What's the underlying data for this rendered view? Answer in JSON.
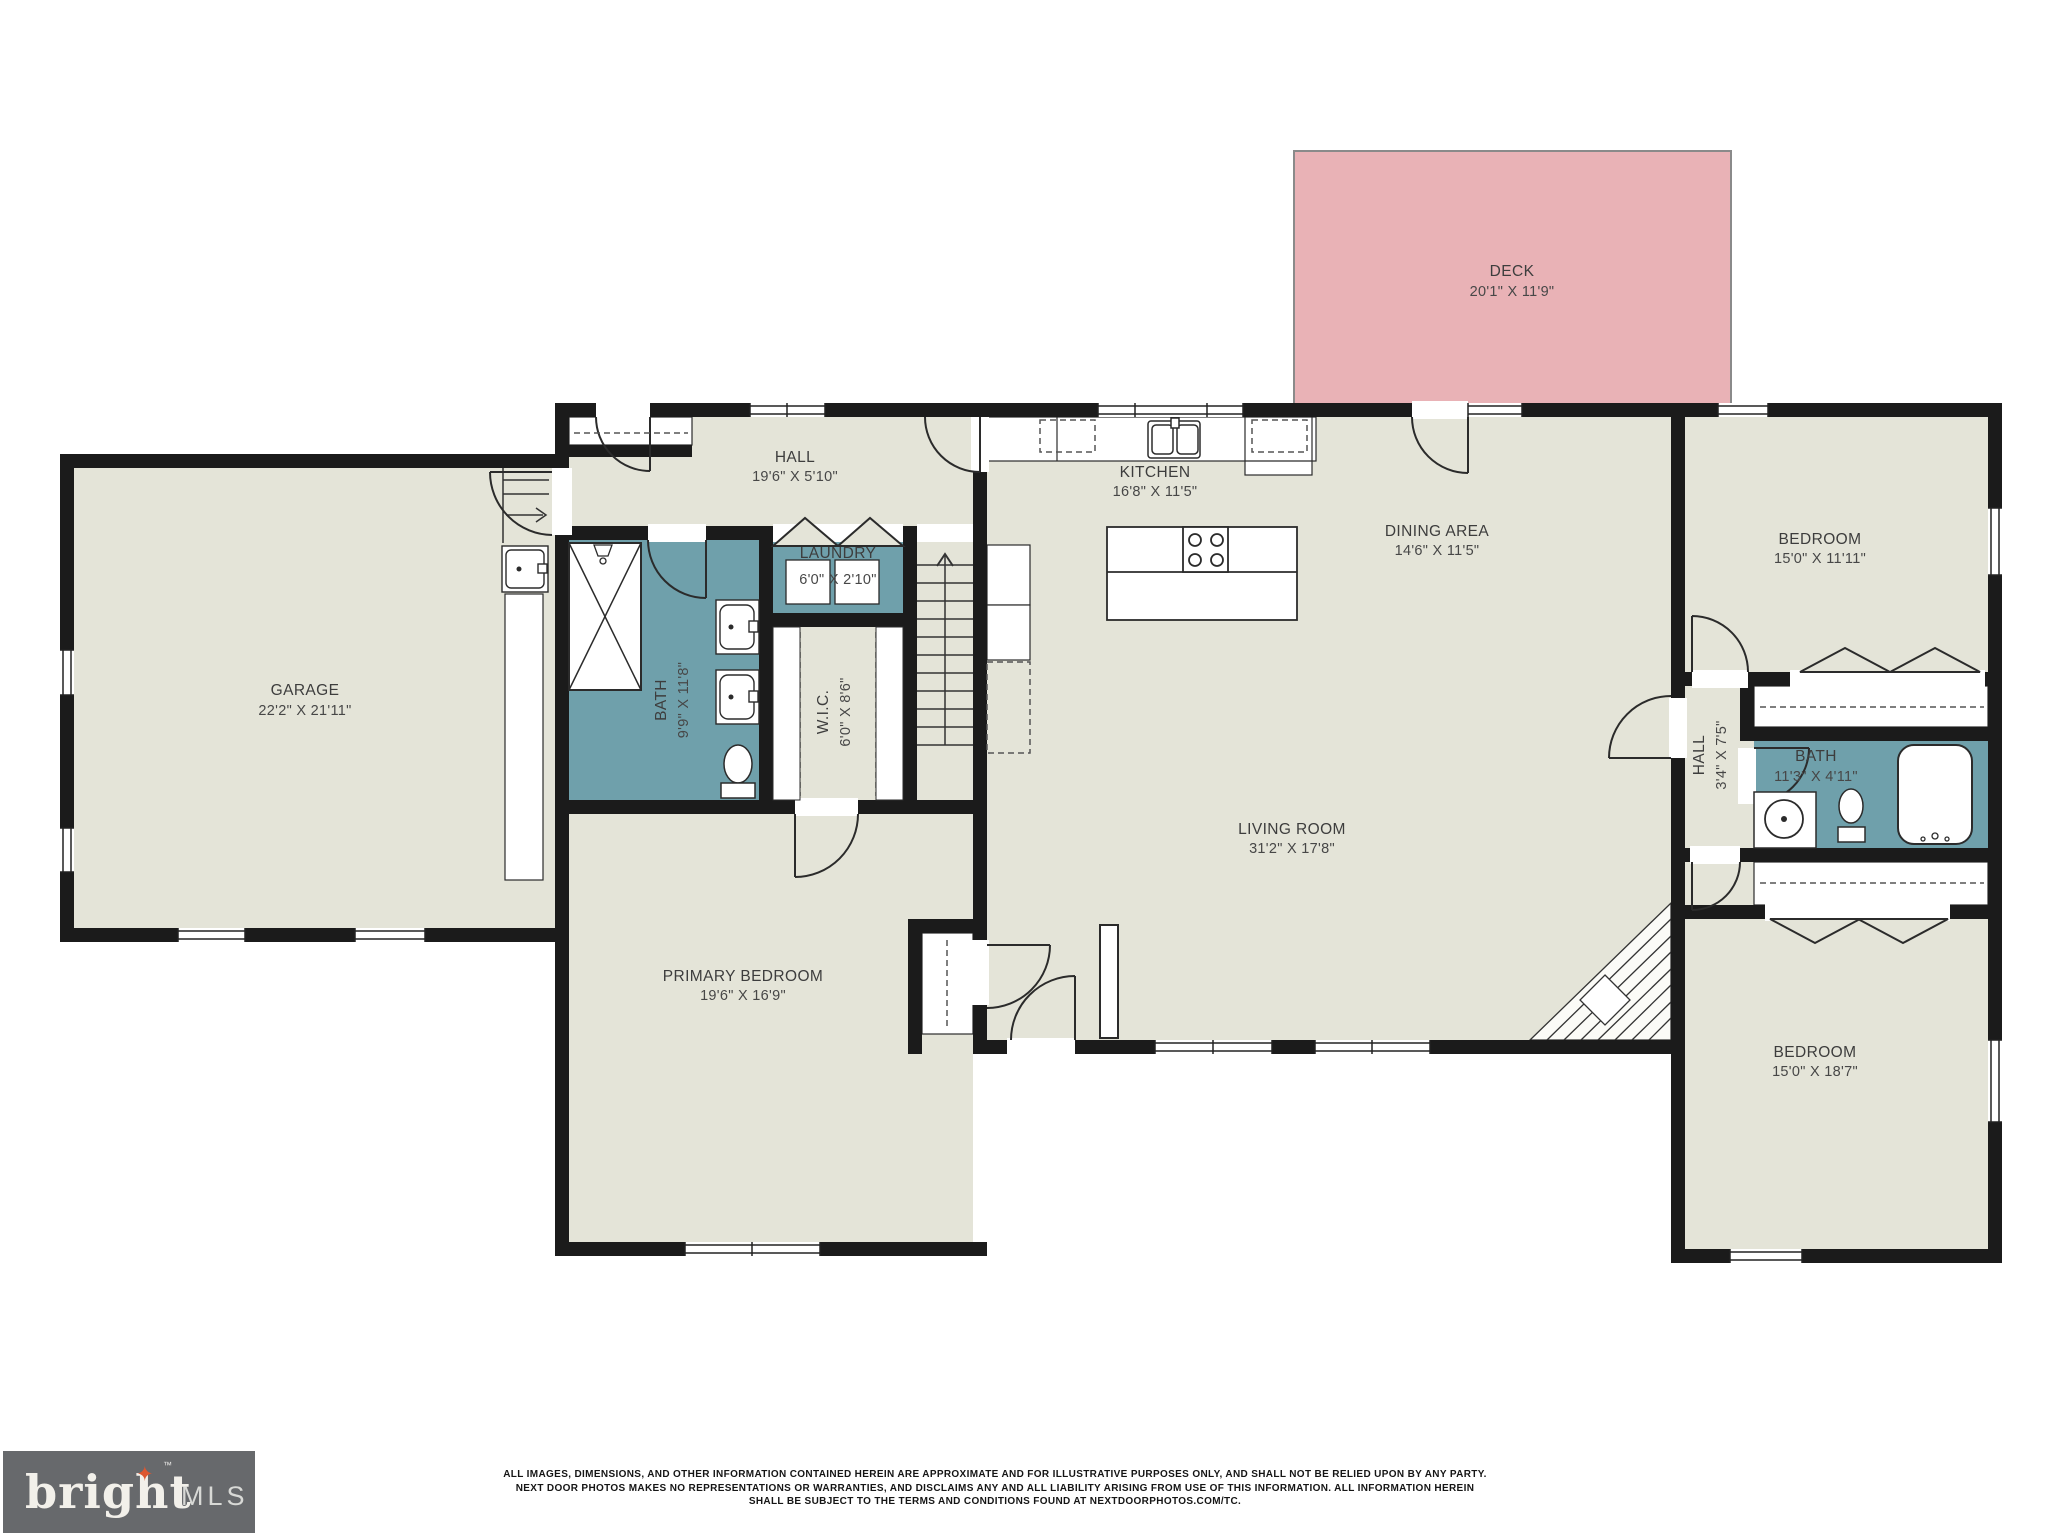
{
  "title": "Residential floor plan",
  "colors": {
    "floor": "#e4e4d8",
    "wet_room": "#6fa0ab",
    "deck": "#e9b2b6",
    "wall": "#1b1b1b",
    "logo_background": "#67696c",
    "logo_star": "#dd5730"
  },
  "rooms": [
    {
      "id": "deck",
      "name": "DECK",
      "dims": "20'1\" X 11'9\""
    },
    {
      "id": "garage",
      "name": "GARAGE",
      "dims": "22'2\" X 21'11\""
    },
    {
      "id": "hall",
      "name": "HALL",
      "dims": "19'6\" X 5'10\""
    },
    {
      "id": "kitchen",
      "name": "KITCHEN",
      "dims": "16'8\" X 11'5\""
    },
    {
      "id": "dining_area",
      "name": "DINING AREA",
      "dims": "14'6\" X 11'5\""
    },
    {
      "id": "laundry",
      "name": "LAUNDRY",
      "dims": "6'0\" X 2'10\""
    },
    {
      "id": "bath",
      "name": "BATH",
      "dims": "9'9\" X 11'8\""
    },
    {
      "id": "wic",
      "name": "W.I.C.",
      "dims": "6'0\" X 8'6\""
    },
    {
      "id": "living_room",
      "name": "LIVING ROOM",
      "dims": "31'2\" X 17'8\""
    },
    {
      "id": "primary",
      "name": "PRIMARY BEDROOM",
      "dims": "19'6\" X 16'9\""
    },
    {
      "id": "bedroom_tr",
      "name": "BEDROOM",
      "dims": "15'0\" X 11'11\""
    },
    {
      "id": "hall2",
      "name": "HALL",
      "dims": "3'4\" X 7'5\""
    },
    {
      "id": "bath2",
      "name": "BATH",
      "dims": "11'3\" X 4'11\""
    },
    {
      "id": "bedroom_br",
      "name": "BEDROOM",
      "dims": "15'0\" X 18'7\""
    }
  ],
  "footer": {
    "logo": {
      "brand": "bright",
      "star_icon": "✦",
      "tm": "™",
      "suffix": "MLS"
    },
    "disclaimer": [
      "ALL IMAGES, DIMENSIONS, AND OTHER INFORMATION CONTAINED HEREIN ARE APPROXIMATE AND FOR ILLUSTRATIVE PURPOSES ONLY, AND SHALL NOT BE RELIED UPON BY ANY PARTY.",
      "NEXT DOOR PHOTOS MAKES NO REPRESENTATIONS OR WARRANTIES, AND DISCLAIMS ANY AND ALL LIABILITY ARISING FROM USE OF THIS INFORMATION. ALL INFORMATION HEREIN",
      "SHALL BE SUBJECT TO THE TERMS AND CONDITIONS FOUND AT NEXTDOORPHOTOS.COM/TC."
    ]
  }
}
